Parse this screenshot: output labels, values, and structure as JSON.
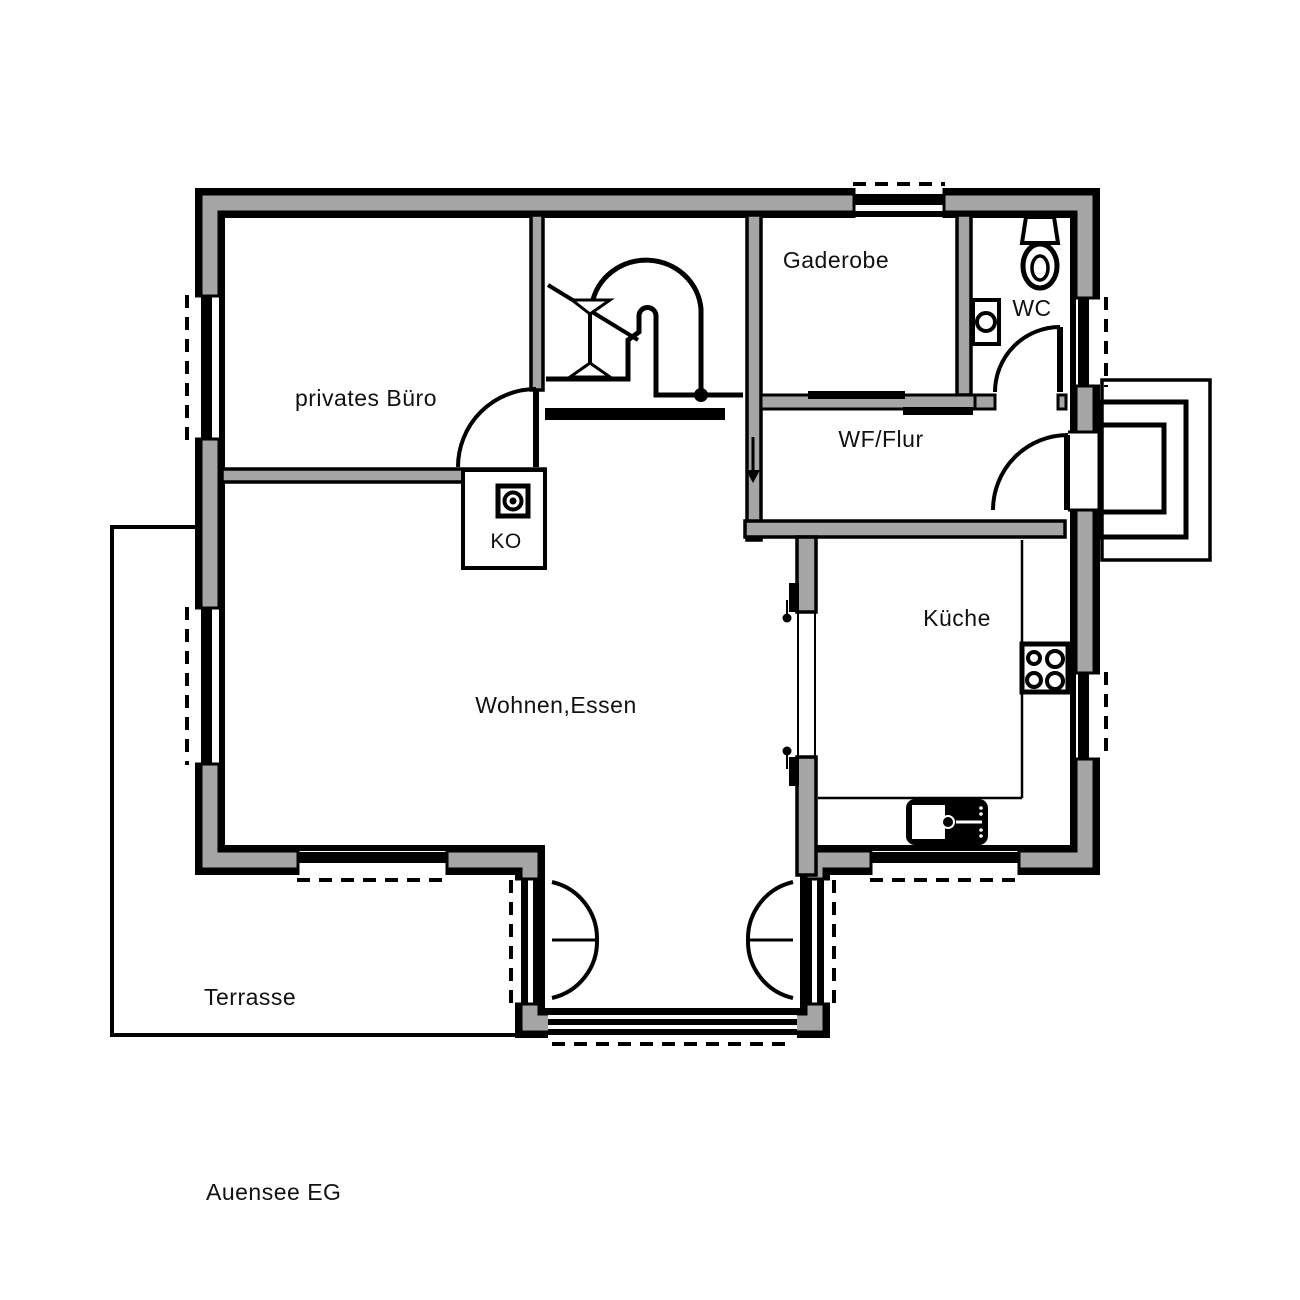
{
  "plan": {
    "title": "Auensee EG",
    "rooms": {
      "buero": "privates Büro",
      "garderobe": "Gaderobe",
      "wc": "WC",
      "flur": "WF/Flur",
      "ko": "KO",
      "kueche": "Küche",
      "wohnen": "Wohnen,Essen",
      "terrasse": "Terrasse"
    },
    "icons": [
      "stair-icon",
      "toilet-icon",
      "hand-basin-icon",
      "stove-icon",
      "kitchen-sink-icon",
      "chimney-icon",
      "entrance-steps"
    ],
    "colors": {
      "wall_fill": "#a5a5a5",
      "line": "#000000",
      "background": "#ffffff"
    }
  }
}
